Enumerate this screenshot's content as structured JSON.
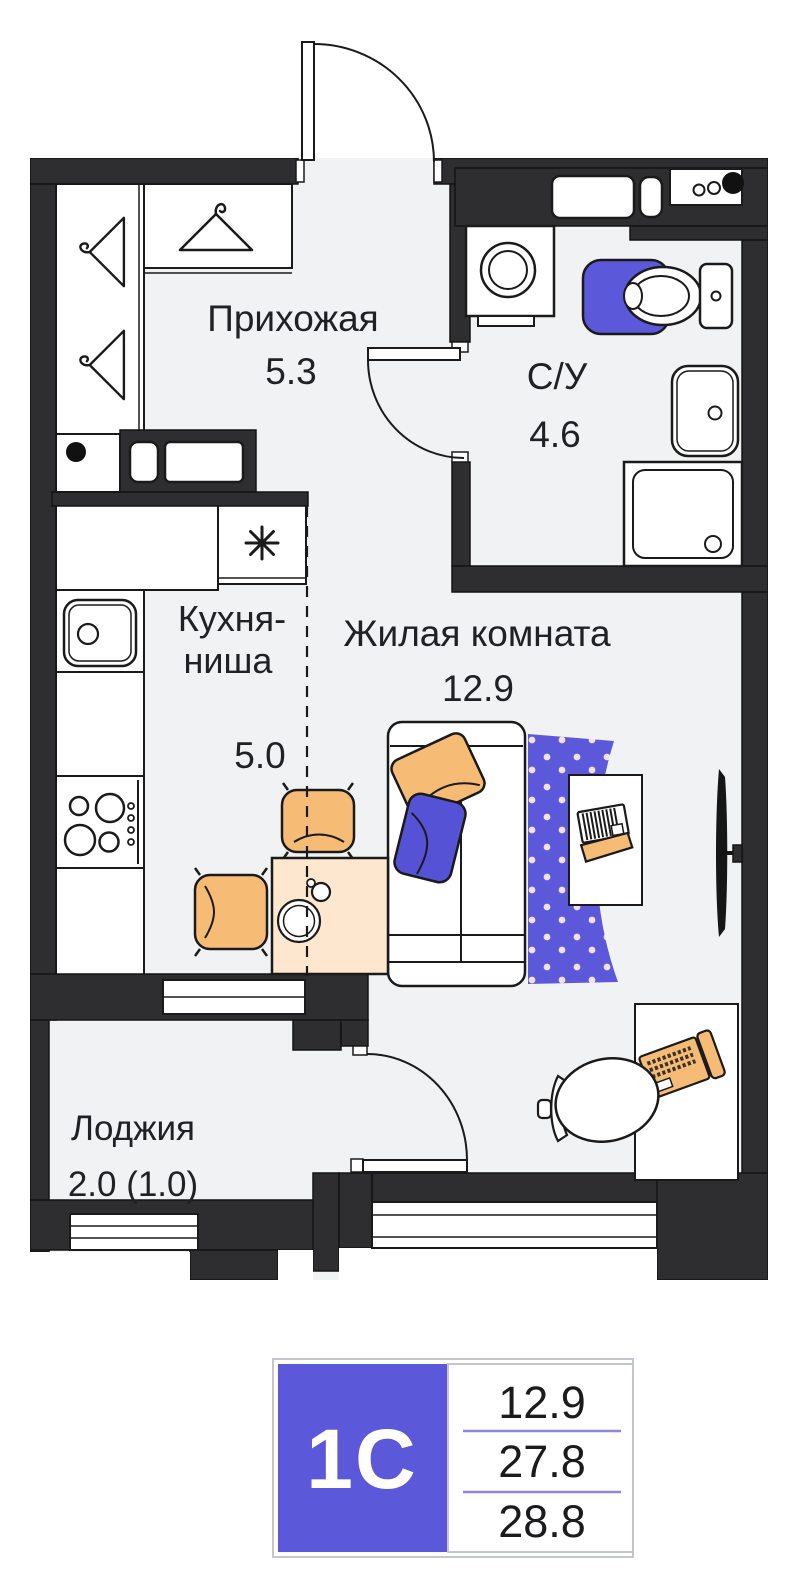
{
  "plan": {
    "rooms": {
      "hallway": {
        "name": "Прихожая",
        "area": "5.3"
      },
      "bathroom": {
        "name": "С/У",
        "area": "4.6"
      },
      "kitchen": {
        "name_line1": "Кухня-",
        "name_line2": "ниша",
        "area": "5.0"
      },
      "living": {
        "name": "Жилая комната",
        "area": "12.9"
      },
      "loggia": {
        "name": "Лоджия",
        "area": "2.0 (1.0)"
      }
    },
    "icons": {
      "hanger_icon": "coat-hanger",
      "fridge_icon": "✳",
      "vent_dot_icon": "●"
    },
    "colors": {
      "wall_dark": "#2e2e30",
      "floor": "#f1f2f3",
      "accent_blue": "#5b58d9",
      "pillow_blue": "#5552d6",
      "furniture_orange": "#f6bc75",
      "table_peach": "#fde8cf",
      "rug_dot": "#f3e0ee",
      "legend_border": "#c3c7cd",
      "legend_separator": "#8987e2"
    }
  },
  "legend": {
    "type": "1С",
    "values": [
      "12.9",
      "27.8",
      "28.8"
    ]
  }
}
